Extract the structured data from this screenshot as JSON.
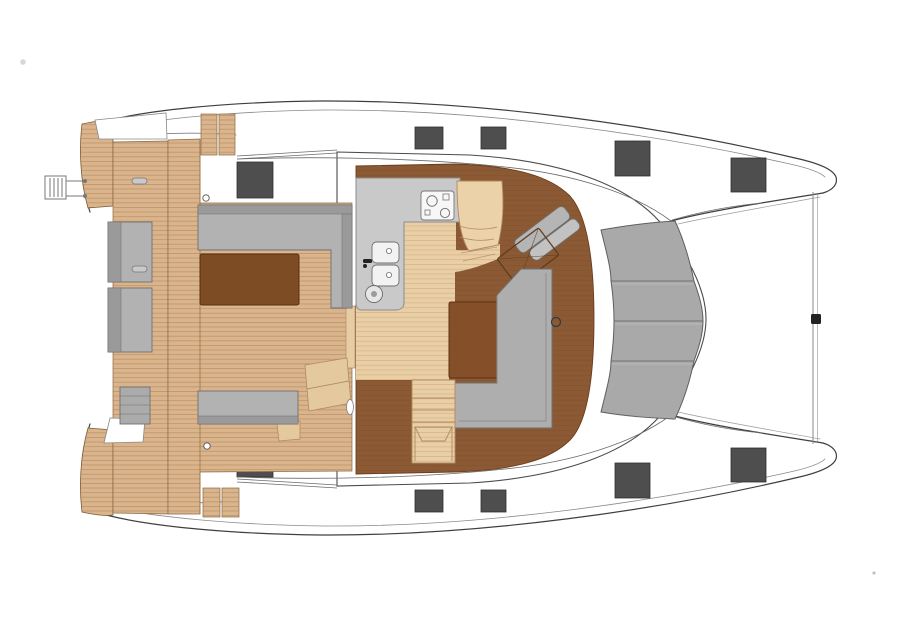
{
  "meta": {
    "title": "Catamaran main-deck floor plan, top view, bow to the right",
    "diagram_type": "boat-deck-plan",
    "visible_text": "none"
  },
  "colors": {
    "background": "#ffffff",
    "outline": "#3f3f3f",
    "thin_line": "#6b6b6b",
    "teak": "#d9b48c",
    "teak_line": "#ac8051",
    "floor_light": "#e9cfa6",
    "floor_light_line": "#cfa878",
    "floor_dark": "#8b5a35",
    "floor_dark_line": "#6f4017",
    "table_dark": "#7d4b24",
    "table_saloon": "#854f2a",
    "furniture_gray": "#b2b2b2",
    "furniture_gray_dark": "#9a9a9a",
    "furniture_stroke": "#6f6f6f",
    "counter_gray": "#c9c9c9",
    "appliance_white": "#f7f7f7",
    "windshield_gray": "#a9a9a9",
    "windshield_stroke": "#5f5f5f",
    "hatch": "#4e4e4e",
    "hatch_stroke": "#2f2f2f",
    "cushion_tan": "#ecd2a9",
    "cushion_tan_stroke": "#b2895f"
  },
  "hatches": [
    {
      "hull": "port",
      "x": 415,
      "y": 127,
      "w": 28,
      "h": 22
    },
    {
      "hull": "port",
      "x": 481,
      "y": 127,
      "w": 25,
      "h": 22
    },
    {
      "hull": "port",
      "x": 615,
      "y": 141,
      "w": 35,
      "h": 35
    },
    {
      "hull": "port",
      "x": 731,
      "y": 158,
      "w": 35,
      "h": 34
    },
    {
      "hull": "port",
      "x": 237,
      "y": 162,
      "w": 36,
      "h": 36
    },
    {
      "hull": "starboard",
      "x": 415,
      "y": 490,
      "w": 28,
      "h": 22
    },
    {
      "hull": "starboard",
      "x": 481,
      "y": 490,
      "w": 25,
      "h": 22
    },
    {
      "hull": "starboard",
      "x": 615,
      "y": 463,
      "w": 35,
      "h": 35
    },
    {
      "hull": "starboard",
      "x": 731,
      "y": 448,
      "w": 35,
      "h": 34
    },
    {
      "hull": "starboard",
      "x": 237,
      "y": 441,
      "w": 36,
      "h": 36
    }
  ],
  "features": [
    {
      "name": "port-hull",
      "label": "port hull (top)"
    },
    {
      "name": "starboard-hull",
      "label": "starboard hull (bottom)"
    },
    {
      "name": "forestay-line",
      "label": "forward crossbeam / forestay"
    },
    {
      "name": "aft-cockpit-deck",
      "label": "aft cockpit teak deck"
    },
    {
      "name": "swim-ladder",
      "label": "swim ladder"
    },
    {
      "name": "cockpit-table",
      "label": "cockpit table"
    },
    {
      "name": "cockpit-benches",
      "label": "cockpit bench seating"
    },
    {
      "name": "coachroof",
      "label": "saloon coachroof"
    },
    {
      "name": "windshield",
      "label": "forward windshield panels"
    },
    {
      "name": "saloon-floor",
      "label": "saloon wood floor"
    },
    {
      "name": "galley-counter",
      "label": "galley counter"
    },
    {
      "name": "stove",
      "label": "cooktop"
    },
    {
      "name": "sinks",
      "label": "double sink"
    },
    {
      "name": "settee",
      "label": "forward settee"
    },
    {
      "name": "helm-seat",
      "label": "angled nav seat"
    },
    {
      "name": "chart-table",
      "label": "angled chart table"
    },
    {
      "name": "dining-table",
      "label": "saloon dining table"
    },
    {
      "name": "l-sofa",
      "label": "L-shaped saloon sofa"
    },
    {
      "name": "companionway-steps",
      "label": "steps down to hull"
    }
  ]
}
